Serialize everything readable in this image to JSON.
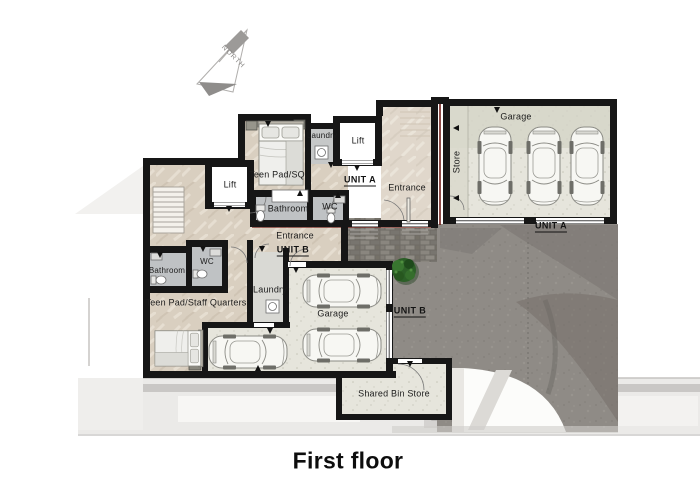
{
  "title": "First floor",
  "compass": {
    "north": "NORTH"
  },
  "units": {
    "unit_a": {
      "name": "UNIT A",
      "rooms": {
        "garage": "Garage",
        "store": "Store",
        "laundry": "Laundry",
        "lift": "Lift",
        "teen_pad": "Teen Pad/SQ",
        "entrance": "Entrance",
        "bathroom": "Bathroom",
        "wc": "WC"
      }
    },
    "unit_b": {
      "name": "UNIT B",
      "rooms": {
        "lift": "Lift",
        "entrance": "Entrance",
        "bathroom": "Bathroom",
        "wc": "WC",
        "teen_pad": "Teen Pad/Staff Quarters",
        "laundry": "Laundry",
        "garage": "Garage"
      }
    },
    "shared": {
      "bin_store": "Shared Bin Store"
    }
  },
  "colors": {
    "wall": "#161616",
    "floor_beige": "#d9cfc0",
    "floor_gray": "#c2c4c5",
    "garage_floor": "#e6e5dc",
    "driveway": "#8f8b86",
    "cobble": "#7e7b75",
    "demise_red": "#6f1d18",
    "bush_green": "#2c5f27",
    "ghost_gray": "#ebeae8"
  }
}
